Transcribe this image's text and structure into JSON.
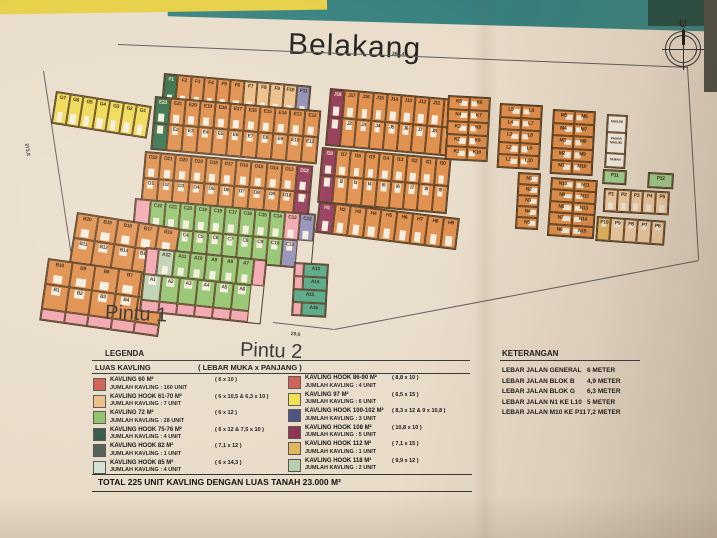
{
  "scene": {
    "title": "Belakang",
    "compass": "U",
    "pintu1": "Pintu 1",
    "pintu2": "Pintu 2",
    "dims": {
      "top": "360,4",
      "left": "273,8",
      "pintu1": "76,3",
      "pintu2": "29,6"
    }
  },
  "colors": {
    "y": "#eed94e",
    "o": "#df8a44",
    "t": "#edbd84",
    "dg": "#2f6b45",
    "g": "#8fc268",
    "sg": "#b9cfae",
    "m": "#8f3050",
    "pu": "#8f8bb4",
    "pk": "#f2a3ab",
    "nv": "#46507e",
    "tg": "#4fa582",
    "gd": "#e2b45a",
    "lt": "#f2cda4",
    "lg": "#9ed18f",
    "wh": "#f6f1e6"
  },
  "blocks": [
    {
      "name": "block-g",
      "x": 56,
      "y": 91,
      "rot": 9,
      "cw": 13.5,
      "ch": 31,
      "c": "y",
      "rows": [
        [
          "G7",
          "G6",
          "G5",
          "G4",
          "G3",
          "G2",
          "G1"
        ]
      ]
    },
    {
      "name": "block-f",
      "x": 164,
      "y": 73,
      "rot": 5,
      "cw": 13.3,
      "ch": 33,
      "c": "o",
      "rows": [
        [
          {
            "l": "F1",
            "c": "dg"
          },
          "F2",
          "F3",
          "F4",
          "F5",
          "F6",
          {
            "l": "F7",
            "c": "t"
          },
          {
            "l": "F8",
            "c": "t"
          },
          {
            "l": "F9",
            "c": "t"
          },
          {
            "l": "F10",
            "c": "t"
          },
          {
            "l": "F11",
            "c": "pu"
          }
        ]
      ]
    },
    {
      "name": "block-e",
      "x": 155,
      "y": 96,
      "rot": 5,
      "cw": 15,
      "ch": 26,
      "c": "o",
      "rows": [
        [
          {
            "l": "E23",
            "c": "dg"
          },
          "E21",
          "E20",
          "E19",
          "E18",
          "E17",
          "E16",
          "E15",
          "E14",
          "E13",
          "E12"
        ],
        [
          {
            "l": "E1",
            "c": "dg"
          },
          "E2",
          "E3",
          "E4",
          "E5",
          "E6",
          "E7",
          "E8",
          "E9",
          "E10",
          "E11"
        ]
      ]
    },
    {
      "name": "block-d",
      "x": 145,
      "y": 151,
      "rot": 5,
      "cw": 15.2,
      "ch": 26,
      "c": "o",
      "rows": [
        [
          "D22",
          "D21",
          "D20",
          "D19",
          "D18",
          "D17",
          "D16",
          "D15",
          "D14",
          "D13",
          {
            "l": "D12",
            "c": "m"
          }
        ],
        [
          "D1",
          "D2",
          "D3",
          "D4",
          "D5",
          "D6",
          "D7",
          "D8",
          "D9",
          "D10",
          {
            "l": "D11",
            "c": "m"
          }
        ]
      ]
    },
    {
      "name": "block-c",
      "x": 135,
      "y": 198,
      "rot": 5,
      "cw": 15,
      "ch": 27,
      "c": "g",
      "rows": [
        [
          {
            "l": "",
            "c": "pk"
          },
          "C22",
          "C21",
          "C20",
          "C19",
          "C18",
          "C17",
          "C16",
          "C15",
          "C14",
          {
            "l": "C13",
            "c": "pk"
          },
          {
            "l": "C12",
            "c": "pu"
          }
        ],
        [
          "C1",
          "C2",
          "C3",
          "C4",
          "C5",
          "C6",
          "C7",
          "C8",
          "C9",
          "C10",
          {
            "l": "C11",
            "c": "pu"
          }
        ]
      ]
    },
    {
      "name": "block-b-upper",
      "x": 77,
      "y": 212,
      "rot": 9,
      "cw": 20.5,
      "ch": 25,
      "c": "o",
      "rows": [
        [
          "B20",
          "B19",
          "B18",
          "B17",
          "B16"
        ],
        [
          "B11",
          "B12",
          "B13",
          "B14",
          "B15"
        ]
      ]
    },
    {
      "name": "block-b-lower",
      "x": 48,
      "y": 258,
      "rot": 8,
      "cw": 23.5,
      "ch": 25,
      "c": "o",
      "rows": [
        [
          "B10",
          "B9",
          "B8",
          "B7",
          "B6"
        ],
        [
          "B1",
          "B2",
          "B3",
          "B4",
          "B5"
        ],
        {
          "h": 11,
          "cells": [
            {
              "l": "",
              "c": "pk"
            },
            {
              "l": "",
              "c": "pk"
            },
            {
              "l": "",
              "c": "pk"
            },
            {
              "l": "",
              "c": "pk"
            },
            {
              "l": "",
              "c": "pk"
            }
          ]
        }
      ]
    },
    {
      "name": "block-a",
      "x": 146,
      "y": 247,
      "rot": 6,
      "cw": 16,
      "ch": 26,
      "c": "g",
      "rows": [
        [
          {
            "l": "",
            "c": "pk",
            "w": 12
          },
          {
            "l": "A12",
            "c": "sg"
          },
          "A11",
          "A10",
          "A9",
          "A8",
          "A7",
          {
            "l": "",
            "c": "pk",
            "w": 12
          }
        ],
        [
          {
            "l": "A1",
            "c": "sg",
            "w": 18
          },
          {
            "l": "A2",
            "w": 18
          },
          {
            "l": "A3",
            "w": 18
          },
          {
            "l": "A4",
            "w": 18
          },
          {
            "l": "A5",
            "w": 18
          },
          {
            "l": "A6",
            "w": 18
          }
        ],
        {
          "h": 11,
          "cells": [
            {
              "l": "",
              "c": "pk",
              "w": 18
            },
            {
              "l": "",
              "c": "pk",
              "w": 18
            },
            {
              "l": "",
              "c": "pk",
              "w": 18
            },
            {
              "l": "",
              "c": "pk",
              "w": 18
            },
            {
              "l": "",
              "c": "pk",
              "w": 18
            },
            {
              "l": "",
              "c": "pk",
              "w": 18
            }
          ]
        }
      ]
    },
    {
      "name": "block-a-column",
      "x": 294,
      "y": 262,
      "rot": 3,
      "cw": 24,
      "ch": 13,
      "c": "tg",
      "nodoor": true,
      "rows": [
        [
          {
            "l": "",
            "c": "pk",
            "w": 9
          },
          {
            "l": "A13"
          }
        ],
        [
          {
            "l": "",
            "c": "pk",
            "w": 9
          },
          {
            "l": "A14"
          }
        ],
        [
          {
            "l": "A15",
            "w": 33
          }
        ],
        [
          {
            "l": "",
            "c": "pk",
            "w": 9
          },
          {
            "l": "A16"
          }
        ]
      ]
    },
    {
      "name": "block-j",
      "x": 330,
      "y": 88,
      "rot": 5,
      "cw": 14.2,
      "ch": 28,
      "c": "o",
      "rows": [
        [
          {
            "l": "J18",
            "c": "m"
          },
          "J17",
          "J16",
          "J15",
          "J14",
          "J13",
          "J12",
          "J11",
          "J10"
        ],
        [
          {
            "l": "J1",
            "c": "m"
          },
          "J2",
          "J3",
          "J4",
          "J5",
          "J6",
          "J7",
          "J8",
          "J9"
        ]
      ]
    },
    {
      "name": "block-i",
      "x": 322,
      "y": 147,
      "rot": 5,
      "cw": 14.2,
      "ch": 27,
      "c": "o",
      "rows": [
        [
          {
            "l": "I18",
            "c": "m"
          },
          "I17",
          "I16",
          "I15",
          "I14",
          "I13",
          "I12",
          "I11",
          "I10"
        ],
        [
          {
            "l": "I1",
            "c": "m"
          },
          "I2",
          "I3",
          "I4",
          "I5",
          "I6",
          "I7",
          "I8",
          "I9"
        ]
      ]
    },
    {
      "name": "block-h",
      "x": 319,
      "y": 201,
      "rot": 7,
      "cw": 15.6,
      "ch": 30,
      "c": "o",
      "rows": [
        [
          {
            "l": "H1",
            "c": "m"
          },
          "H2",
          "H3",
          "H4",
          "H5",
          "H6",
          "H7",
          "H8",
          "H9"
        ]
      ]
    },
    {
      "name": "block-k",
      "x": 448,
      "y": 95,
      "rot": 3,
      "cw": 20.5,
      "ch": 12.6,
      "c": "o",
      "v": true,
      "rows": [
        [
          "K5",
          "K6"
        ],
        [
          "K4",
          "K7"
        ],
        [
          "K3",
          "K8"
        ],
        [
          "K2",
          "K9"
        ],
        [
          "K1",
          "K10"
        ]
      ]
    },
    {
      "name": "block-l",
      "x": 500,
      "y": 103,
      "rot": 3,
      "cw": 20.5,
      "ch": 12.6,
      "c": "o",
      "v": true,
      "rows": [
        [
          "L5",
          "L6"
        ],
        [
          "L4",
          "L7"
        ],
        [
          "L3",
          "L8"
        ],
        [
          "L2",
          "L9"
        ],
        [
          "L1",
          "L10"
        ]
      ]
    },
    {
      "name": "block-m",
      "x": 553,
      "y": 109,
      "rot": 3,
      "cw": 20.5,
      "ch": 12.6,
      "c": "o",
      "v": true,
      "rows": [
        [
          "M5",
          "M6"
        ],
        [
          "M4",
          "M7"
        ],
        [
          "M3",
          "M8"
        ],
        [
          "M2",
          "M9"
        ],
        [
          "M1",
          "M10"
        ]
      ]
    },
    {
      "name": "facility-strip",
      "x": 607,
      "y": 114,
      "rot": 3,
      "cw": 19,
      "ch": 17,
      "c": "wh",
      "nodoor": true,
      "fs": 3.2,
      "rows": [
        {
          "h": 17,
          "cells": [
            "MASJID"
          ]
        },
        {
          "h": 21,
          "cells": [
            "PASAR MASJID"
          ]
        },
        {
          "h": 14,
          "cells": [
            "TAMAN"
          ]
        }
      ]
    },
    {
      "name": "block-n-column",
      "x": 518,
      "y": 172,
      "rot": 3,
      "cw": 21,
      "ch": 11,
      "c": "o",
      "door": "r",
      "rows": [
        [
          "N1"
        ],
        [
          "N2"
        ],
        [
          "N3"
        ],
        [
          "N4"
        ],
        [
          "N5"
        ]
      ]
    },
    {
      "name": "block-n",
      "x": 551,
      "y": 177,
      "rot": 4,
      "cw": 22.5,
      "ch": 11.4,
      "c": "o",
      "v": true,
      "rows": [
        [
          "N10",
          "N11"
        ],
        [
          "N9",
          "N12"
        ],
        [
          "N8",
          "N13"
        ],
        [
          "N7",
          "N14"
        ],
        [
          "N6",
          "N15"
        ]
      ]
    },
    {
      "name": "plot-p11",
      "x": 603,
      "y": 169,
      "rot": 3,
      "cw": 22,
      "ch": 13,
      "c": "lg",
      "nodoor": true,
      "rows": [
        [
          "P11"
        ]
      ]
    },
    {
      "name": "plot-p12",
      "x": 648,
      "y": 172,
      "rot": 3,
      "cw": 24,
      "ch": 14,
      "c": "lg",
      "nodoor": true,
      "rows": [
        [
          "P12"
        ]
      ]
    },
    {
      "name": "block-p-upper",
      "x": 604,
      "y": 188,
      "rot": 3,
      "cw": 12.8,
      "ch": 22,
      "c": "lt",
      "door": "b",
      "rows": [
        [
          "P1",
          "P2",
          "P3",
          "P4",
          "P5"
        ]
      ]
    },
    {
      "name": "block-p-lower",
      "x": 597,
      "y": 216,
      "rot": 4,
      "cw": 13.4,
      "ch": 23,
      "c": "lt",
      "door": "t",
      "rows": [
        [
          {
            "l": "P10",
            "c": "gd"
          },
          "P9",
          "P8",
          "P7",
          "P6"
        ]
      ]
    }
  ],
  "legend": {
    "title": "LEGENDA",
    "col_header": "LUAS KAVLING",
    "size_header": "( LEBAR MUKA x PANJANG )",
    "left": [
      {
        "color": "#cd5c50",
        "name": "KAVLING 60 M²",
        "sub": "JUMLAH KAVLING : 160 UNIT",
        "dims": "( 6 x 10 )"
      },
      {
        "color": "#edbd84",
        "name": "KAVLING HOOK 61-70 M²",
        "sub": "JUMLAH KAVLING : 7 UNIT",
        "dims": "( 6 x 10,5 & 6,3 x 10 )"
      },
      {
        "color": "#8fc268",
        "name": "KAVLING 72 M²",
        "sub": "JUMLAH KAVLING : 28 UNIT",
        "dims": "( 6 x 12 )"
      },
      {
        "color": "#33584a",
        "name": "KAVLING HOOK 75-76 M²",
        "sub": "JUMLAH KAVLING : 4 UNIT",
        "dims": "( 6 x 12 & 7,5 x 10 )"
      },
      {
        "color": "#555f5a",
        "name": "KAVLING HOOK 82 M²",
        "sub": "JUMLAH KAVLING : 1 UNIT",
        "dims": "( 7,1 x 12 )"
      },
      {
        "color": "#d4e2d2",
        "name": "KAVLING HOOK 85 M²",
        "sub": "JUMLAH KAVLING : 4 UNIT",
        "dims": "( 6 x 14,3 )"
      }
    ],
    "right": [
      {
        "color": "#cd5c50",
        "name": "KAVLING HOOK 86-90 M²",
        "sub": "JUMLAH KAVLING : 4 UNIT",
        "dims": "( 8,8 x 10 )"
      },
      {
        "color": "#f0e14e",
        "name": "KAVLING 97 M²",
        "sub": "JUMLAH KAVLING : 6 UNIT",
        "dims": "( 6,5 x 15 )"
      },
      {
        "color": "#46507e",
        "name": "KAVLING HOOK 100-102 M²",
        "sub": "JUMLAH KAVLING : 3 UNIT",
        "dims": "( 8,3 x 12 & 9 x 10,8 )"
      },
      {
        "color": "#8f3050",
        "name": "KAVLING HOOK 108 M²",
        "sub": "JUMLAH KAVLING : 5 UNIT",
        "dims": "( 10,8 x 10 )"
      },
      {
        "color": "#e2b45a",
        "name": "KAVLING HOOK 112 M²",
        "sub": "JUMLAH KAVLING : 1 UNIT",
        "dims": "( 7,1 x 15 )"
      },
      {
        "color": "#b9cfae",
        "name": "KAVLING HOOK 118 M²",
        "sub": "JUMLAH KAVLING : 2 UNIT",
        "dims": "( 9,9 x 12 )"
      }
    ]
  },
  "keterangan": {
    "title": "KETERANGAN",
    "rows": [
      {
        "label": "LEBAR JALAN GENERAL",
        "value": "6 METER"
      },
      {
        "label": "LEBAR JALAN BLOK B",
        "value": "4,9 METER"
      },
      {
        "label": "LEBAR JALAN BLOK G",
        "value": "6,3 METER"
      },
      {
        "label": "LEBAR JALAN N1 KE L10",
        "value": "5 METER"
      },
      {
        "label": "LEBAR JALAN M10 KE P11",
        "value": "7,2 METER"
      }
    ]
  },
  "total": "TOTAL 225 UNIT KAVLING DENGAN LUAS TANAH 23.000 M²"
}
